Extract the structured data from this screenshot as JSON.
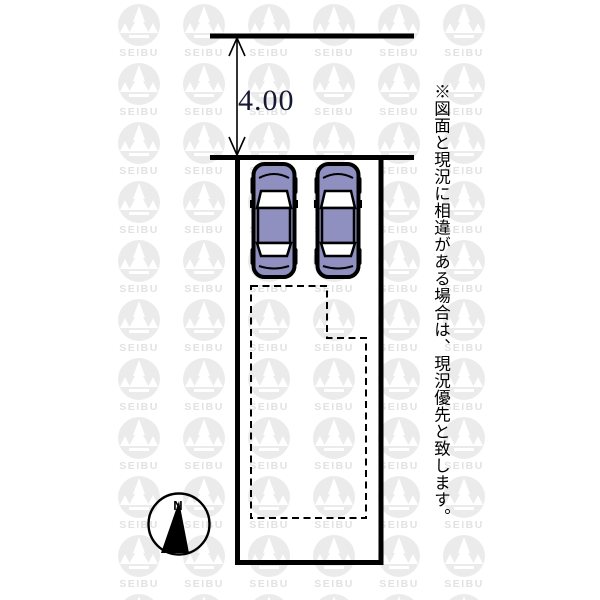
{
  "dimension": {
    "label": "4.00"
  },
  "note": {
    "text": "※図面と現況に相違がある場合は、現況優先と致します。"
  },
  "compass": {
    "north_label": "N"
  },
  "watermark": {
    "brand_text": "SEIBU"
  },
  "cars": {
    "count": 2
  },
  "colors": {
    "car_body": "#8f8fc0",
    "line": "#000000",
    "watermark_grey": "#ebebeb",
    "watermark_text_grey": "#e2e2e2",
    "dimension_text": "#181835"
  }
}
